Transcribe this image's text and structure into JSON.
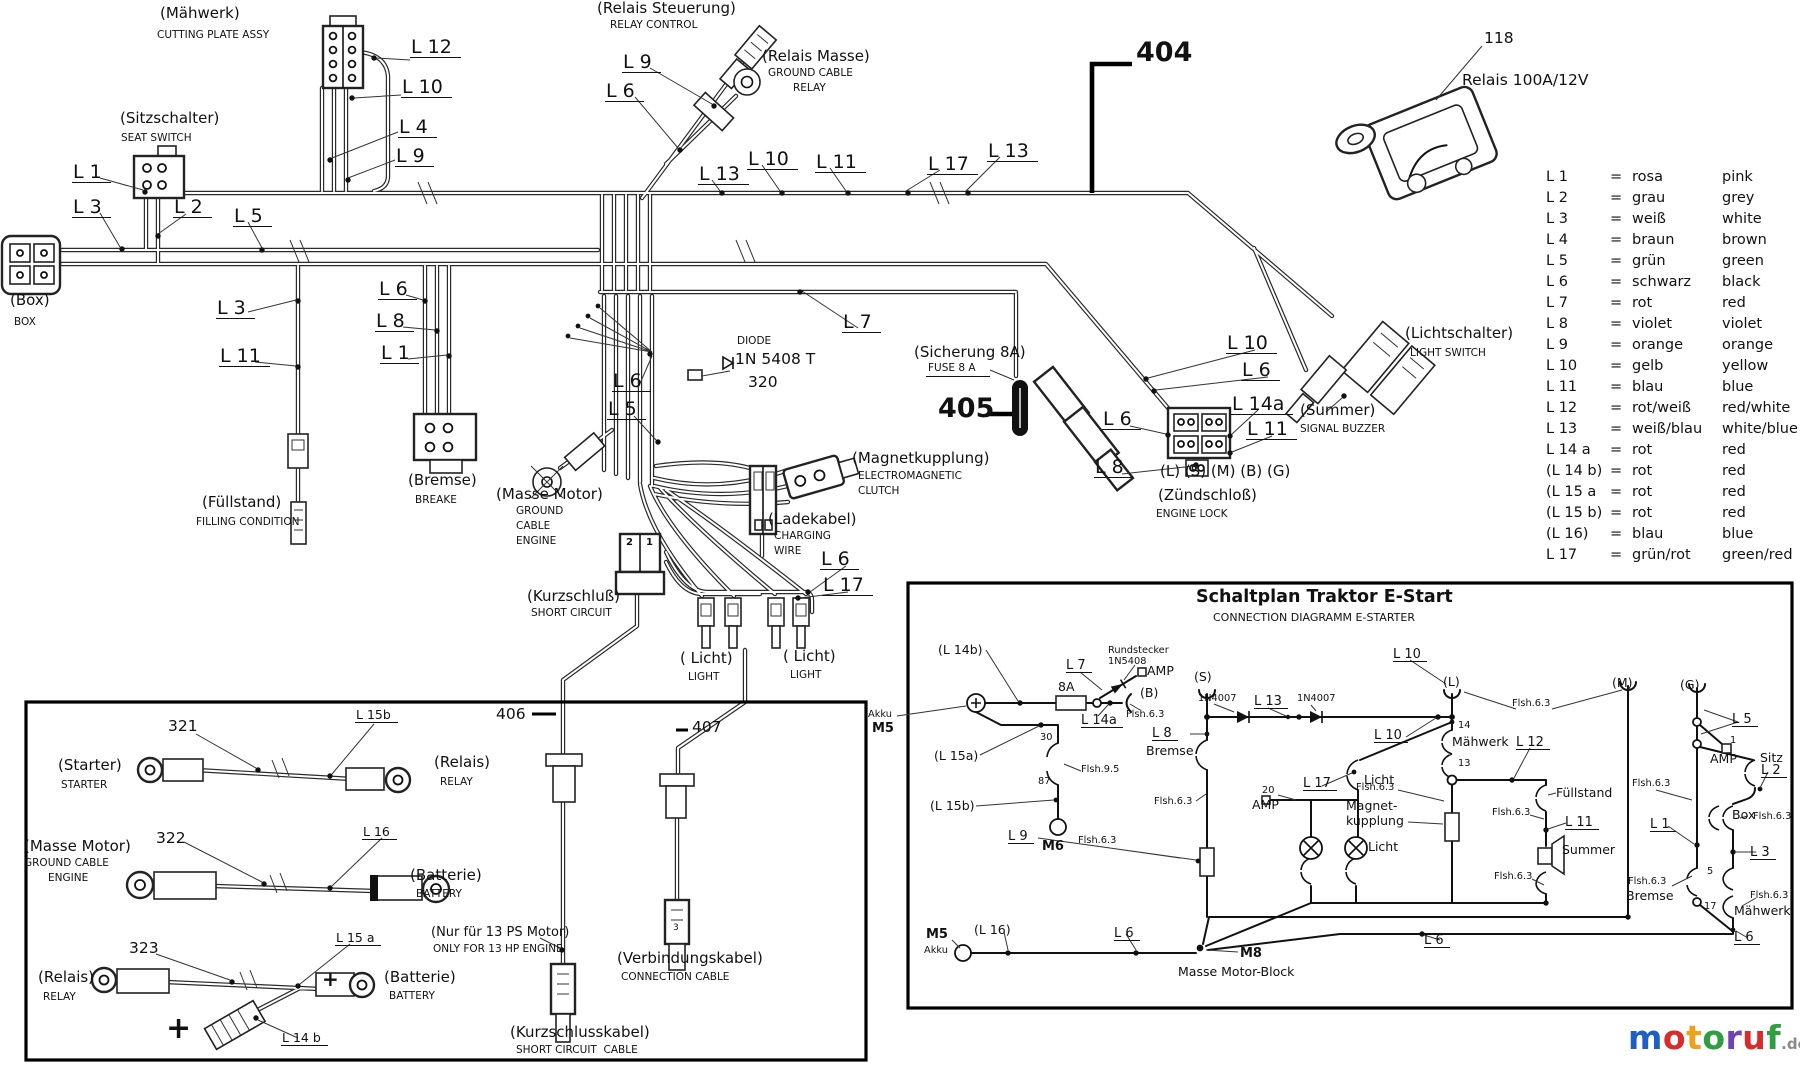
{
  "harness": {
    "components": {
      "maehwerk": {
        "de": "(Mähwerk)",
        "en": "CUTTING PLATE ASSY"
      },
      "sitzschalter": {
        "de": "(Sitzschalter)",
        "en": "SEAT SWITCH"
      },
      "box": {
        "de": "(Box)",
        "en": "BOX"
      },
      "fuellstand": {
        "de": "(Füllstand)",
        "en": "FILLING CONDITION"
      },
      "bremse": {
        "de": "(Bremse)",
        "en": "BREAKE"
      },
      "relais_steuerung": {
        "de": "(Relais Steuerung)",
        "en": "RELAY CONTROL"
      },
      "relais_masse": {
        "de": "(Relais Masse)",
        "en1": "GROUND CABLE",
        "en2": "RELAY"
      },
      "masse_motor": {
        "de": "(Masse Motor)",
        "en1": "GROUND",
        "en2": "CABLE",
        "en3": "ENGINE"
      },
      "ladekabel": {
        "de": "(Ladekabel)",
        "en1": "CHARGING",
        "en2": "WIRE"
      },
      "magnetkupplung": {
        "de": "(Magnetkupplung)",
        "en1": "ELECTROMAGNETIC",
        "en2": "CLUTCH"
      },
      "kurzschluss": {
        "de": "(Kurzschluß)",
        "en": "SHORT CIRCUIT"
      },
      "licht1": {
        "de": "( Licht)",
        "en": "LIGHT"
      },
      "licht2": {
        "de": "( Licht)",
        "en": "LIGHT"
      },
      "sicherung": {
        "de": "(Sicherung 8A)",
        "en": "FUSE 8 A"
      },
      "zuendschloss": {
        "pins": "(L) (S) (M) (B) (G)",
        "de": "(Zündschloß)",
        "en": "ENGINE LOCK"
      },
      "summer": {
        "de": "(Summer)",
        "en": "SIGNAL BUZZER"
      },
      "lichtschalter": {
        "de": "(Lichtschalter)",
        "en": "LIGHT SWITCH"
      },
      "relais118": {
        "num": "118",
        "name": "Relais 100A/12V"
      },
      "diode": {
        "t": "DIODE",
        "part": "1N 5408 T",
        "num": "320"
      }
    },
    "markers": {
      "m404": "404",
      "m405": "405"
    },
    "kurzschluss_pins": [
      "2",
      "1"
    ],
    "tags": [
      "L 12",
      "L 10",
      "L 4",
      "L 9",
      "L 1",
      "L 3",
      "L 2",
      "L 5",
      "L 3",
      "L 11",
      "L 6",
      "L 8",
      "L 1",
      "L 9",
      "L 6",
      "L 13",
      "L 10",
      "L 11",
      "L 17",
      "L 13",
      "L 7",
      "L 6",
      "L 5",
      "L 6",
      "L 17",
      "L 10",
      "L 6",
      "L 14a",
      "L 11",
      "L 6",
      "L 8"
    ]
  },
  "legend": {
    "eq": "=",
    "rows": [
      {
        "id": "L 1",
        "de": "rosa",
        "en": "pink"
      },
      {
        "id": "L 2",
        "de": "grau",
        "en": "grey"
      },
      {
        "id": "L 3",
        "de": "weiß",
        "en": "white"
      },
      {
        "id": "L 4",
        "de": "braun",
        "en": "brown"
      },
      {
        "id": "L 5",
        "de": "grün",
        "en": "green"
      },
      {
        "id": "L 6",
        "de": "schwarz",
        "en": "black"
      },
      {
        "id": "L 7",
        "de": "rot",
        "en": "red"
      },
      {
        "id": "L 8",
        "de": "violet",
        "en": "violet"
      },
      {
        "id": "L 9",
        "de": "orange",
        "en": "orange"
      },
      {
        "id": "L 10",
        "de": "gelb",
        "en": "yellow"
      },
      {
        "id": "L 11",
        "de": "blau",
        "en": "blue"
      },
      {
        "id": "L 12",
        "de": "rot/weiß",
        "en": "red/white"
      },
      {
        "id": "L 13",
        "de": "weiß/blau",
        "en": "white/blue"
      },
      {
        "id": "L 14 a",
        "de": "rot",
        "en": "red"
      },
      {
        "id": "(L 14 b)",
        "de": "rot",
        "en": "red"
      },
      {
        "id": "(L 15 a",
        "de": "rot",
        "en": "red"
      },
      {
        "id": "(L 15 b)",
        "de": "rot",
        "en": "red"
      },
      {
        "id": "(L 16)",
        "de": "blau",
        "en": "blue"
      },
      {
        "id": "L 17",
        "de": "grün/rot",
        "en": "green/red"
      }
    ]
  },
  "parts_box": {
    "rows": [
      {
        "num": "321",
        "wire": "L 15b",
        "left_de": "(Starter)",
        "left_en": "STARTER",
        "right_de": "(Relais)",
        "right_en": "RELAY"
      },
      {
        "num": "322",
        "wire": "L 16",
        "left_de": "(Masse Motor)",
        "left_en1": "GROUND CABLE",
        "left_en2": "ENGINE",
        "right_de": "(Batterie)",
        "right_en": "BATTERY"
      },
      {
        "num": "323",
        "wire": "L 15 a",
        "left_de": "(Relais)",
        "left_en": "RELAY",
        "right_de": "(Batterie)",
        "right_en": "BATTERY",
        "branch_wire": "L 14 b",
        "plus_big": "+",
        "plus_small": "+"
      }
    ],
    "cable406": {
      "num": "406",
      "note_de": "(Nur für 13 PS Motor)",
      "note_en": "ONLY FOR 13 HP ENGINE",
      "name_de": "(Kurzschlusskabel)",
      "name_en": "SHORT CIRCUIT  CABLE"
    },
    "cable407": {
      "num": "407",
      "pin": "3",
      "name_de": "(Verbindungskabel)",
      "name_en": "CONNECTION CABLE"
    }
  },
  "schematic": {
    "title": "Schaltplan Traktor E-Start",
    "subtitle": "CONNECTION DIAGRAMM E-STARTER",
    "labels": [
      "(L 14b)",
      "Akku",
      "M5",
      "L 7",
      "8A",
      "Rundstecker",
      "1N5408",
      "AMP",
      "(B)",
      "Flsh.6.3",
      "L 14a",
      "(L 15a)",
      "30",
      "Flsh.9.5",
      "87",
      "(L 15b)",
      "M6",
      "(S)",
      "L 8",
      "Bremse",
      "Flsh.6.3",
      "1N4007",
      "L 13",
      "1N4007",
      "L 10",
      "(L)",
      "Flsh.6.3",
      "(M)",
      "(G)",
      "L 10",
      "14",
      "Mähwerk",
      "L 12",
      "13",
      "L 17",
      "Licht",
      "20",
      "AMP",
      "Licht",
      "Magnet-",
      "kupplung",
      "Flsh.6.3",
      "Füllstand",
      "Flsh.6.3",
      "L 11",
      "Summer",
      "Flsh.6.3",
      "L 9",
      "Flsh.6.3",
      "L 5",
      "1",
      "AMP",
      "Sitz",
      "L 2",
      "Flsh.6.3",
      "L 1",
      "Box",
      "Flsh.6.3",
      "L 3",
      "5",
      "Flsh.6.3",
      "Bremse",
      "17",
      "Flsh.6.3",
      "Mähwerk",
      "M5",
      "Akku",
      "(L 16)",
      "L 6",
      "M8",
      "Masse Motor-Block",
      "L 6",
      "L 6"
    ]
  },
  "logo": {
    "letters": [
      {
        "ch": "m",
        "color": "#1d5fc2"
      },
      {
        "ch": "o",
        "color": "#d92b2b"
      },
      {
        "ch": "t",
        "color": "#f0a11c"
      },
      {
        "ch": "o",
        "color": "#2e9e3f"
      },
      {
        "ch": "r",
        "color": "#6f42b8"
      },
      {
        "ch": "u",
        "color": "#d92b2b"
      },
      {
        "ch": "f",
        "color": "#2e9e3f"
      }
    ],
    "suffix": ".de"
  }
}
